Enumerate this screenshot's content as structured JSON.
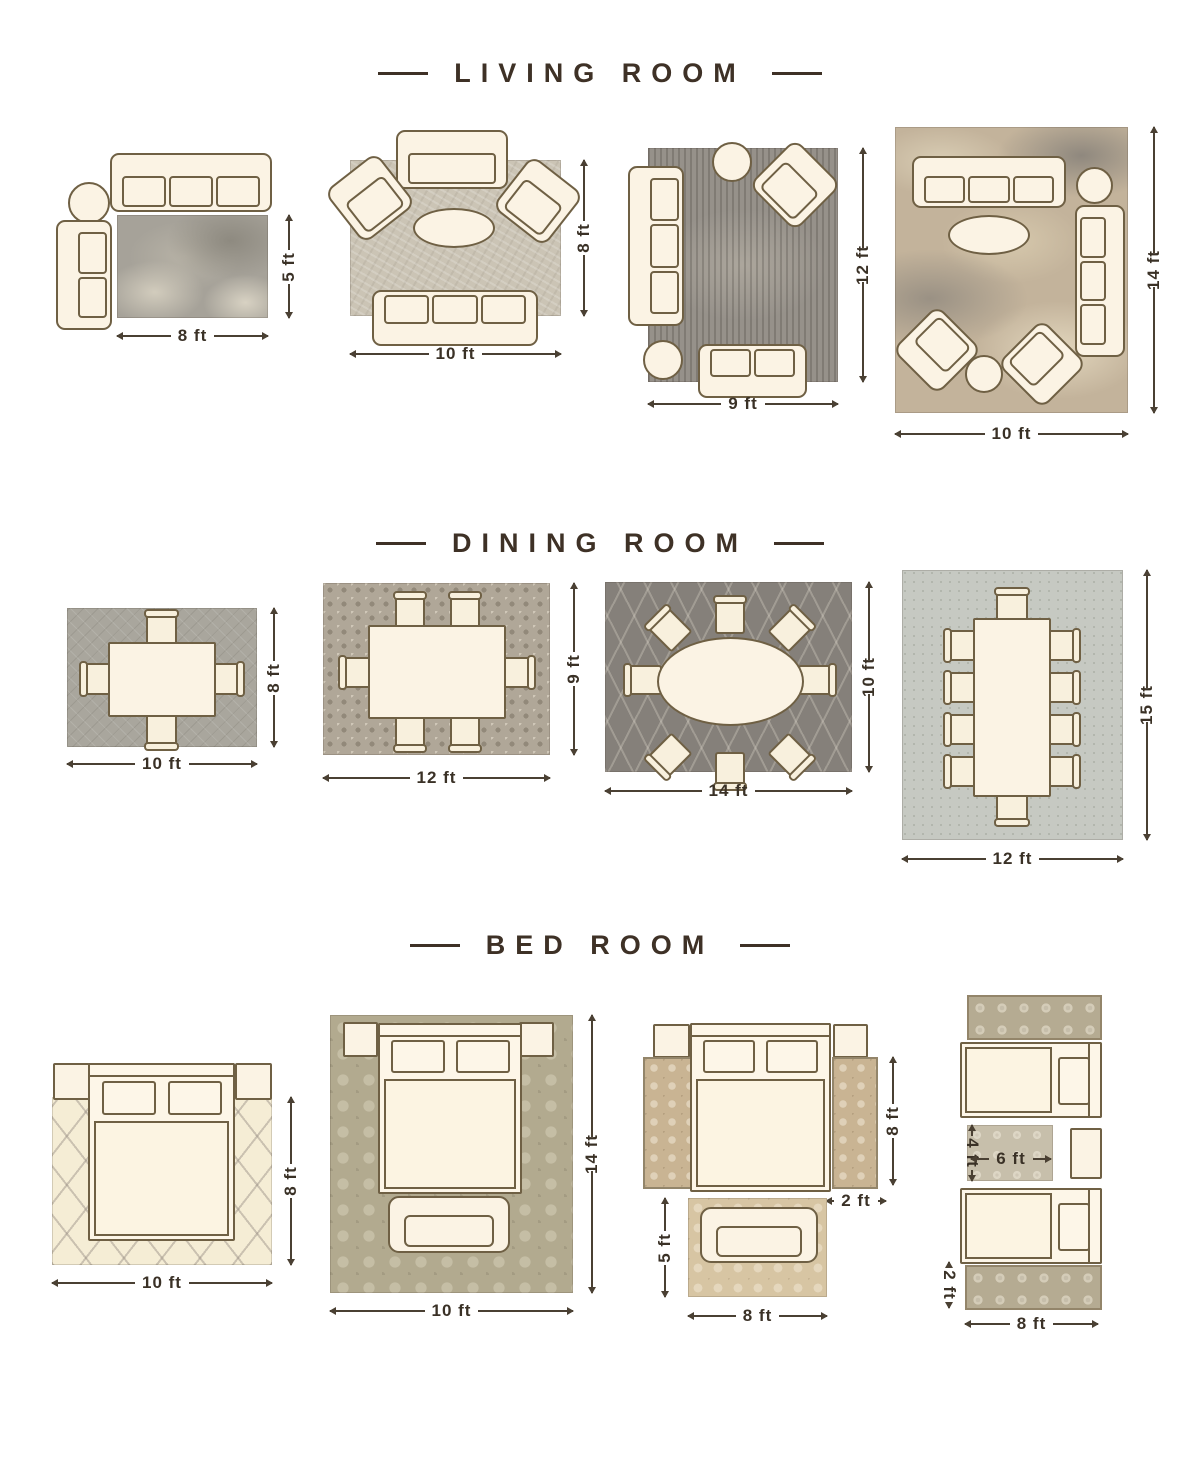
{
  "palette": {
    "background": "#ffffff",
    "title_text": "#3e3126",
    "dimension_text": "#3a3126",
    "furniture_fill": "#fbf3e4",
    "furniture_outline": "#6f6044"
  },
  "sections": [
    {
      "title": "LIVING ROOM",
      "layouts": [
        {
          "name": "living-room-layout-1",
          "furniture": [
            "sofa",
            "round-side-table",
            "settee"
          ],
          "dims": {
            "width": "8 ft",
            "height": "5 ft"
          }
        },
        {
          "name": "living-room-layout-2",
          "furniture": [
            "loveseat",
            "armchair",
            "armchair",
            "oval-coffee-table",
            "sofa"
          ],
          "dims": {
            "width": "10 ft",
            "height": "8 ft"
          }
        },
        {
          "name": "living-room-layout-3",
          "furniture": [
            "sofa",
            "round-side-table",
            "armchair",
            "loveseat",
            "round-ottoman"
          ],
          "dims": {
            "width": "9 ft",
            "height": "12 ft"
          }
        },
        {
          "name": "living-room-layout-4",
          "furniture": [
            "sofa",
            "round-side-table",
            "sofa",
            "oval-coffee-table",
            "armchair",
            "armchair",
            "round-ottoman"
          ],
          "dims": {
            "width": "10 ft",
            "height": "14 ft"
          }
        }
      ]
    },
    {
      "title": "DINING ROOM",
      "layouts": [
        {
          "name": "dining-room-layout-1",
          "furniture": [
            "rectangular-table",
            "4-chairs"
          ],
          "dims": {
            "width": "10 ft",
            "height": "8 ft"
          }
        },
        {
          "name": "dining-room-layout-2",
          "furniture": [
            "rectangular-table",
            "6-chairs"
          ],
          "dims": {
            "width": "12 ft",
            "height": "9 ft"
          }
        },
        {
          "name": "dining-room-layout-3",
          "furniture": [
            "oval-table",
            "8-chairs"
          ],
          "dims": {
            "width": "14 ft",
            "height": "10 ft"
          }
        },
        {
          "name": "dining-room-layout-4",
          "furniture": [
            "rectangular-table",
            "10-chairs"
          ],
          "dims": {
            "width": "12 ft",
            "height": "15 ft"
          }
        }
      ]
    },
    {
      "title": "BED ROOM",
      "layouts": [
        {
          "name": "bed-room-layout-1",
          "furniture": [
            "nightstand",
            "bed",
            "nightstand"
          ],
          "dims": {
            "width": "10 ft",
            "height": "8 ft"
          }
        },
        {
          "name": "bed-room-layout-2",
          "furniture": [
            "nightstand",
            "bed",
            "nightstand",
            "bench"
          ],
          "dims": {
            "width": "10 ft",
            "height": "14 ft"
          }
        },
        {
          "name": "bed-room-layout-3",
          "furniture": [
            "nightstand",
            "bed",
            "nightstand",
            "side-runner",
            "side-runner",
            "bench",
            "foot-rug"
          ],
          "dims": {
            "runner_length": "8 ft",
            "runner_width": "2 ft",
            "rug_height": "5 ft",
            "rug_width": "8 ft"
          }
        },
        {
          "name": "bed-room-layout-4",
          "furniture": [
            "runner",
            "twin-bed",
            "accent-rug",
            "nightstand",
            "twin-bed",
            "runner"
          ],
          "dims": {
            "rug_height": "4 ft",
            "rug_width": "6 ft",
            "runner_width": "2 ft",
            "width": "8 ft"
          }
        }
      ]
    }
  ]
}
